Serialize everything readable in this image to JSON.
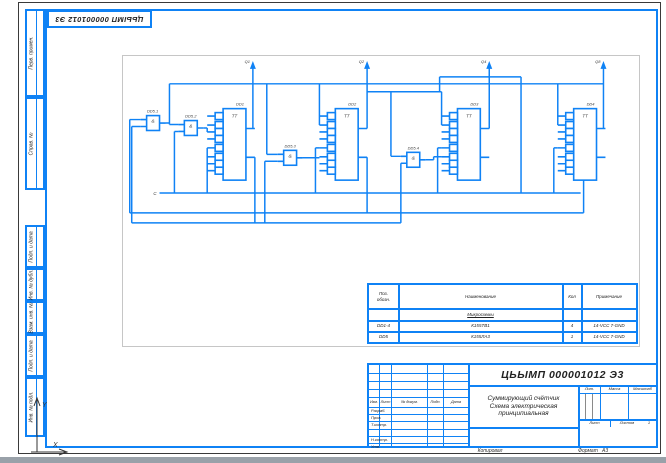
{
  "sheet": {
    "copied_label": "Копировал",
    "format_label": "Формат",
    "format_value": "A3",
    "axis": {
      "x": "X",
      "y": "Y"
    }
  },
  "margin_labels": {
    "perv_primen": "Перв. примен.",
    "sprav_no": "Справ. №",
    "podp_data_1": "Подп. и дата",
    "inv_dubl": "Инв. № дубл.",
    "vzam_inv": "Взам. инв. №",
    "podp_data_2": "Подп. и дата",
    "inv_podl": "Инв. № подл."
  },
  "title_block": {
    "doc_number": "ЦЬЫМП 000001012 Э3",
    "product_title": "Суммирующий счётчик",
    "doc_type_line1": "Схема электрическая",
    "doc_type_line2": "принципиальная",
    "columns": {
      "izm": "Изм.",
      "list": "Лист",
      "ndokum": "№ докум.",
      "podp": "Подп.",
      "data": "Дата"
    },
    "rows": {
      "razrab": "Разраб.",
      "prov": "Пров.",
      "tkontr": "Т.контр.",
      "nkontr": "Н.контр.",
      "utv": "Утв."
    },
    "lit_label": "Лит.",
    "massa_label": "Масса",
    "masshtab_label": "Масштаб",
    "list_label": "Лист",
    "listov_label": "Листов",
    "listov_value": "1"
  },
  "bom": {
    "header": {
      "pos_line1": "Поз.",
      "pos_line2": "обозн.",
      "name": "Наименование",
      "qty": "Кол",
      "note": "Примечание"
    },
    "section": "Микросхемы",
    "rows": [
      {
        "pos": "DD1-4",
        "name": "К155ТВ1",
        "qty": "4",
        "note": "14-VCC 7-GND"
      },
      {
        "pos": "DD5",
        "name": "К155ЛА3",
        "qty": "1",
        "note": "14-VCC 7-GND"
      }
    ]
  },
  "schematic": {
    "clock_label": "C",
    "outputs": [
      "Q1",
      "Q2",
      "Q4",
      "Q8"
    ],
    "flipflops": [
      {
        "ref": "DD1",
        "func": "TT"
      },
      {
        "ref": "DD2",
        "func": "TT"
      },
      {
        "ref": "DD3",
        "func": "TT"
      },
      {
        "ref": "DD4",
        "func": "TT"
      }
    ],
    "gates": [
      {
        "ref": "DD5.1",
        "func": "&"
      },
      {
        "ref": "DD5.2",
        "func": "&"
      },
      {
        "ref": "DD5.3",
        "func": "&"
      },
      {
        "ref": "DD5.4",
        "func": "&"
      }
    ]
  },
  "colors": {
    "line_blue": "#0f82f5",
    "ink": "#222222",
    "frame_gray": "#c6c6c6",
    "band_gray": "#99a1a9"
  }
}
